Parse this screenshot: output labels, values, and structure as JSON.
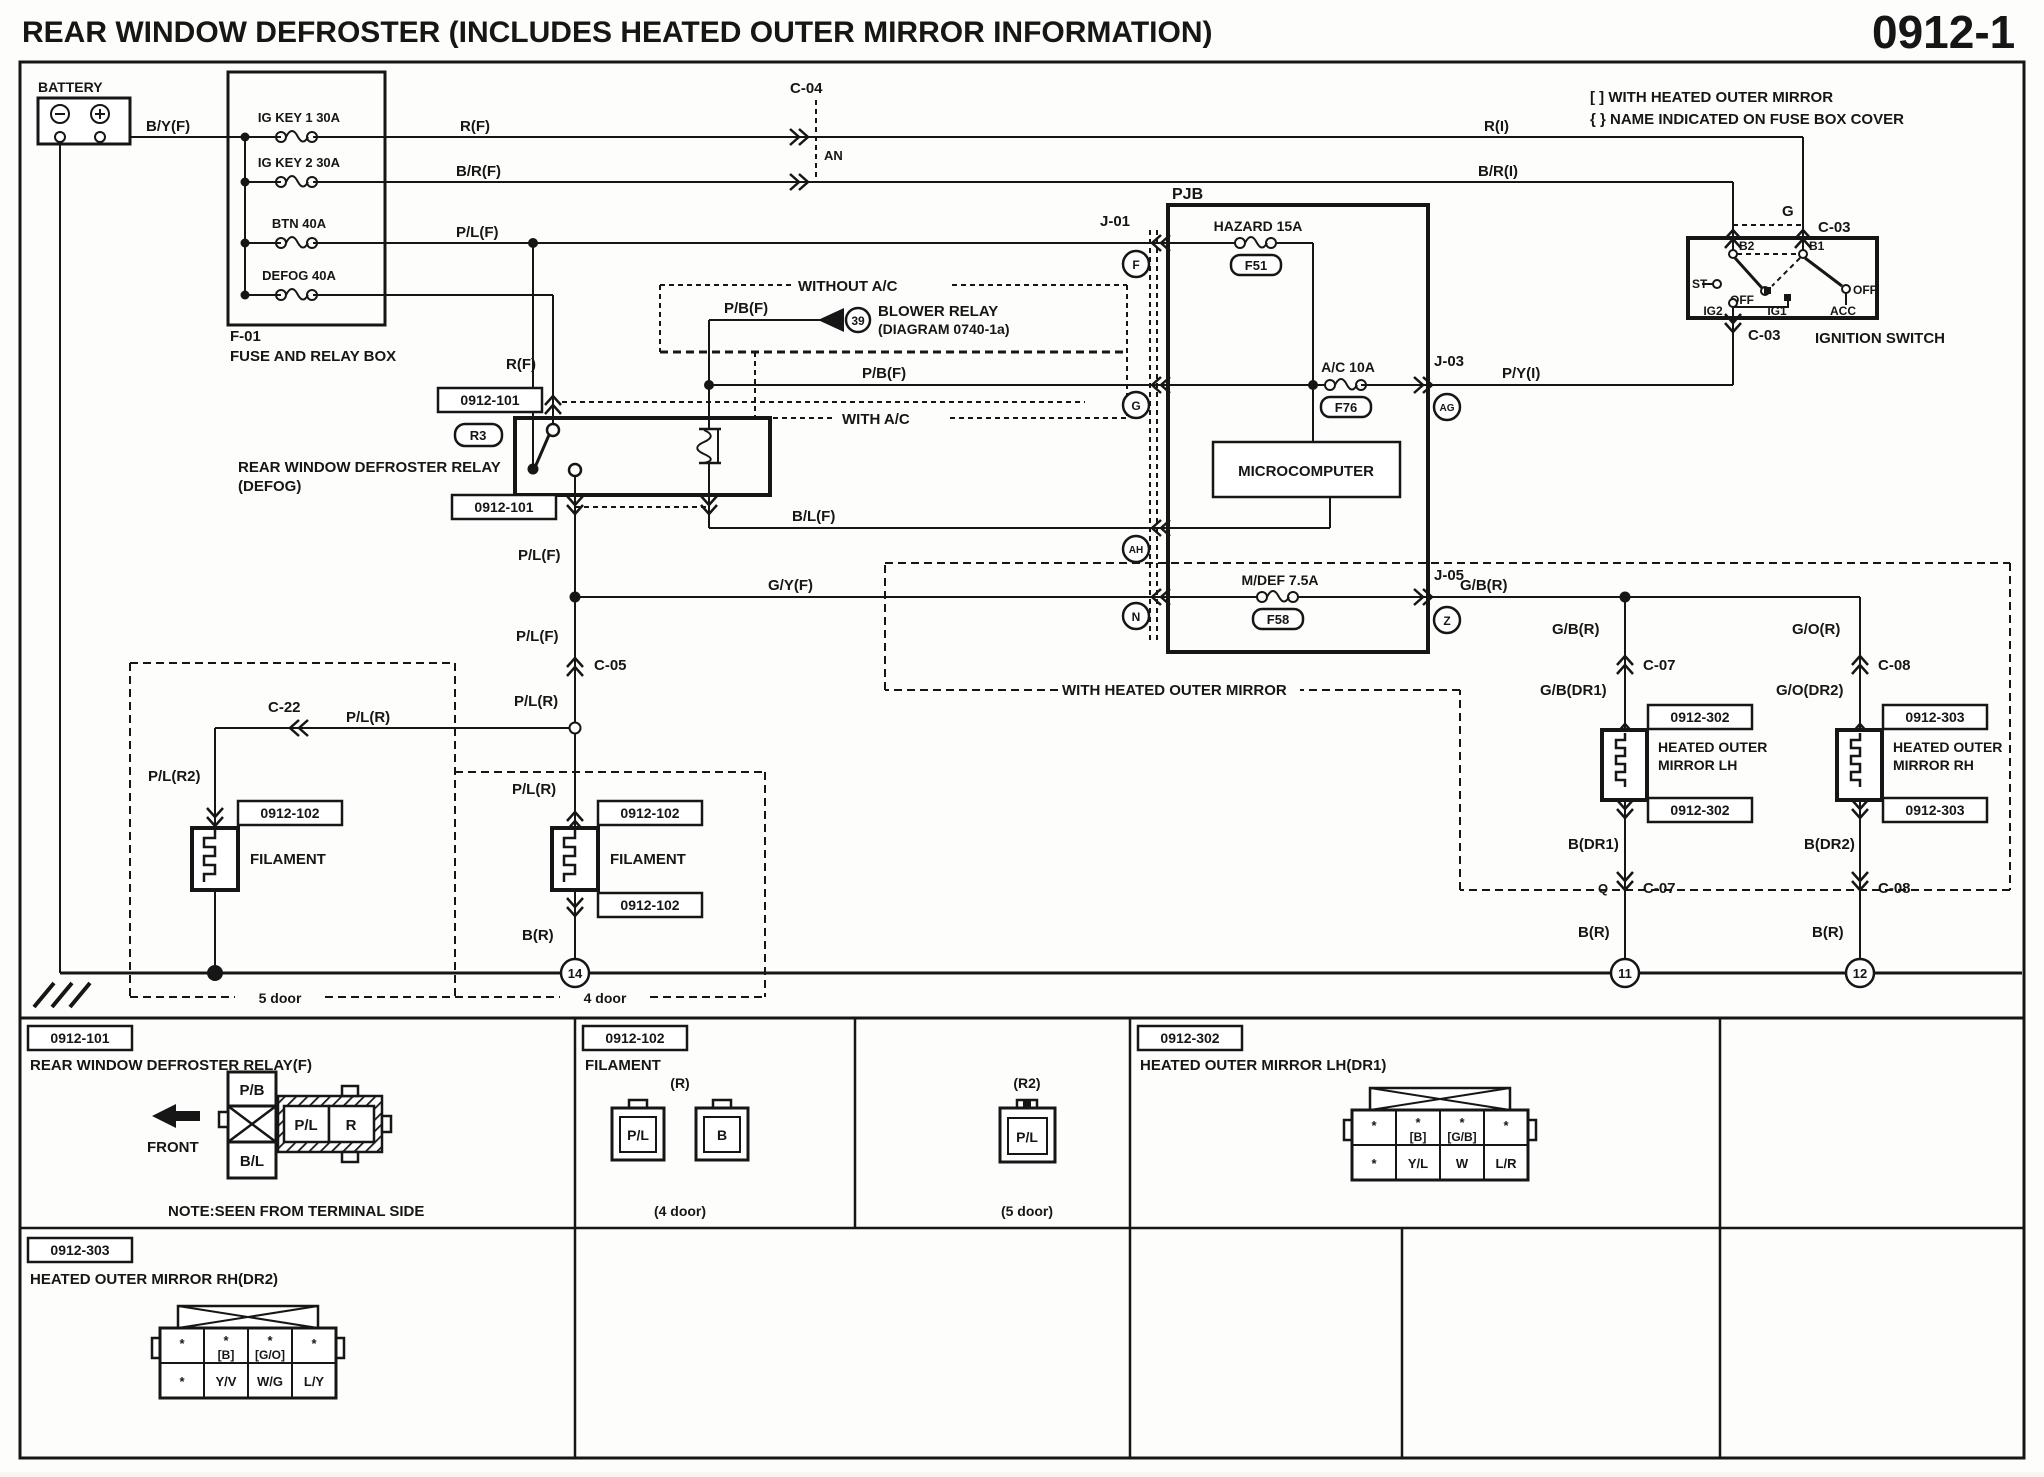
{
  "header": {
    "title": "REAR WINDOW DEFROSTER (INCLUDES HEATED OUTER MIRROR INFORMATION)",
    "page": "0912-1"
  },
  "notes": {
    "n1": "[ ] WITH HEATED OUTER MIRROR",
    "n2": "{ } NAME INDICATED ON FUSE BOX COVER"
  },
  "battery": {
    "label": "BATTERY"
  },
  "fusebox": {
    "id": "F-01",
    "name": "FUSE AND RELAY BOX",
    "fuses": [
      "IG KEY 1 30A",
      "IG KEY 2 30A",
      "BTN 40A",
      "DEFOG 40A"
    ]
  },
  "pjb": {
    "label": "PJB",
    "hazard": "HAZARD 15A",
    "f51": "F51",
    "ac": "A/C 10A",
    "f76": "F76",
    "mdef": "M/DEF 7.5A",
    "f58": "F58",
    "micro": "MICROCOMPUTER"
  },
  "ignition": {
    "name": "IGNITION SWITCH",
    "b1": "B1",
    "b2": "B2",
    "st": "ST",
    "off": "OFF",
    "ig1": "IG1",
    "ig2": "IG2",
    "acc": "ACC"
  },
  "relay": {
    "r3": "R3",
    "name1": "REAR WINDOW DEFROSTER RELAY",
    "name2": "(DEFOG)"
  },
  "blower": {
    "num": "39",
    "name1": "BLOWER RELAY",
    "name2": "(DIAGRAM 0740-1a)",
    "without_ac": "WITHOUT A/C",
    "with_ac": "WITH A/C"
  },
  "wires": {
    "byf": "B/Y(F)",
    "rf": "R(F)",
    "ri": "R(I)",
    "brf": "B/R(F)",
    "bri": "B/R(I)",
    "plf": "P/L(F)",
    "pbf": "P/B(F)",
    "blf": "B/L(F)",
    "gyf": "G/Y(F)",
    "pyi": "P/Y(I)",
    "gbr": "G/B(R)",
    "gor": "G/O(R)",
    "gbdr1": "G/B(DR1)",
    "godr2": "G/O(DR2)",
    "plr": "P/L(R)",
    "plr2": "P/L(R2)",
    "bdr1": "B(DR1)",
    "bdr2": "B(DR2)",
    "br": "B(R)",
    "g": "G"
  },
  "conns": {
    "c04": "C-04",
    "an": "AN",
    "c03": "C-03",
    "j01": "J-01",
    "j03": "J-03",
    "j05": "J-05",
    "c05": "C-05",
    "c22": "C-22",
    "c07": "C-07",
    "c08": "C-08",
    "q": "Q",
    "f": "F",
    "g": "G",
    "ah": "AH",
    "n": "N",
    "z": "Z",
    "ag": "AG"
  },
  "refs": {
    "r101": "0912-101",
    "r102": "0912-102",
    "r302": "0912-302",
    "r303": "0912-303"
  },
  "mirrors": {
    "lh1": "HEATED OUTER",
    "lh2": "MIRROR LH",
    "rh1": "HEATED OUTER",
    "rh2": "MIRROR RH",
    "hom": "WITH HEATED OUTER MIRROR"
  },
  "filament": {
    "label": "FILAMENT"
  },
  "doors": {
    "d5": "5 door",
    "d4": "4 door"
  },
  "grounds": {
    "n14": "14",
    "n11": "11",
    "n12": "12"
  },
  "tables": {
    "t101": {
      "tag": "0912-101",
      "title": "REAR WINDOW DEFROSTER RELAY(F)",
      "front": "FRONT",
      "note": "NOTE:SEEN FROM TERMINAL SIDE",
      "pins": {
        "pb": "P/B",
        "pl": "P/L",
        "r": "R",
        "bl": "B/L"
      }
    },
    "t102": {
      "tag": "0912-102",
      "title": "FILAMENT",
      "rl": "(R)",
      "r2l": "(R2)",
      "pl": "P/L",
      "b": "B",
      "pl2": "P/L",
      "cap4": "(4 door)",
      "cap5": "(5 door)"
    },
    "t302": {
      "tag": "0912-302",
      "title": "HEATED OUTER MIRROR LH(DR1)",
      "row1_top": [
        "*",
        "*",
        "*",
        "*"
      ],
      "row1_sub": [
        "",
        "[B]",
        "[G/B]",
        ""
      ],
      "row2": [
        "*",
        "Y/L",
        "W",
        "L/R"
      ]
    },
    "t303": {
      "tag": "0912-303",
      "title": "HEATED OUTER MIRROR RH(DR2)",
      "row1_top": [
        "*",
        "*",
        "*",
        "*"
      ],
      "row1_sub": [
        "",
        "[B]",
        "[G/O]",
        ""
      ],
      "row2": [
        "*",
        "Y/V",
        "W/G",
        "L/Y"
      ]
    }
  }
}
